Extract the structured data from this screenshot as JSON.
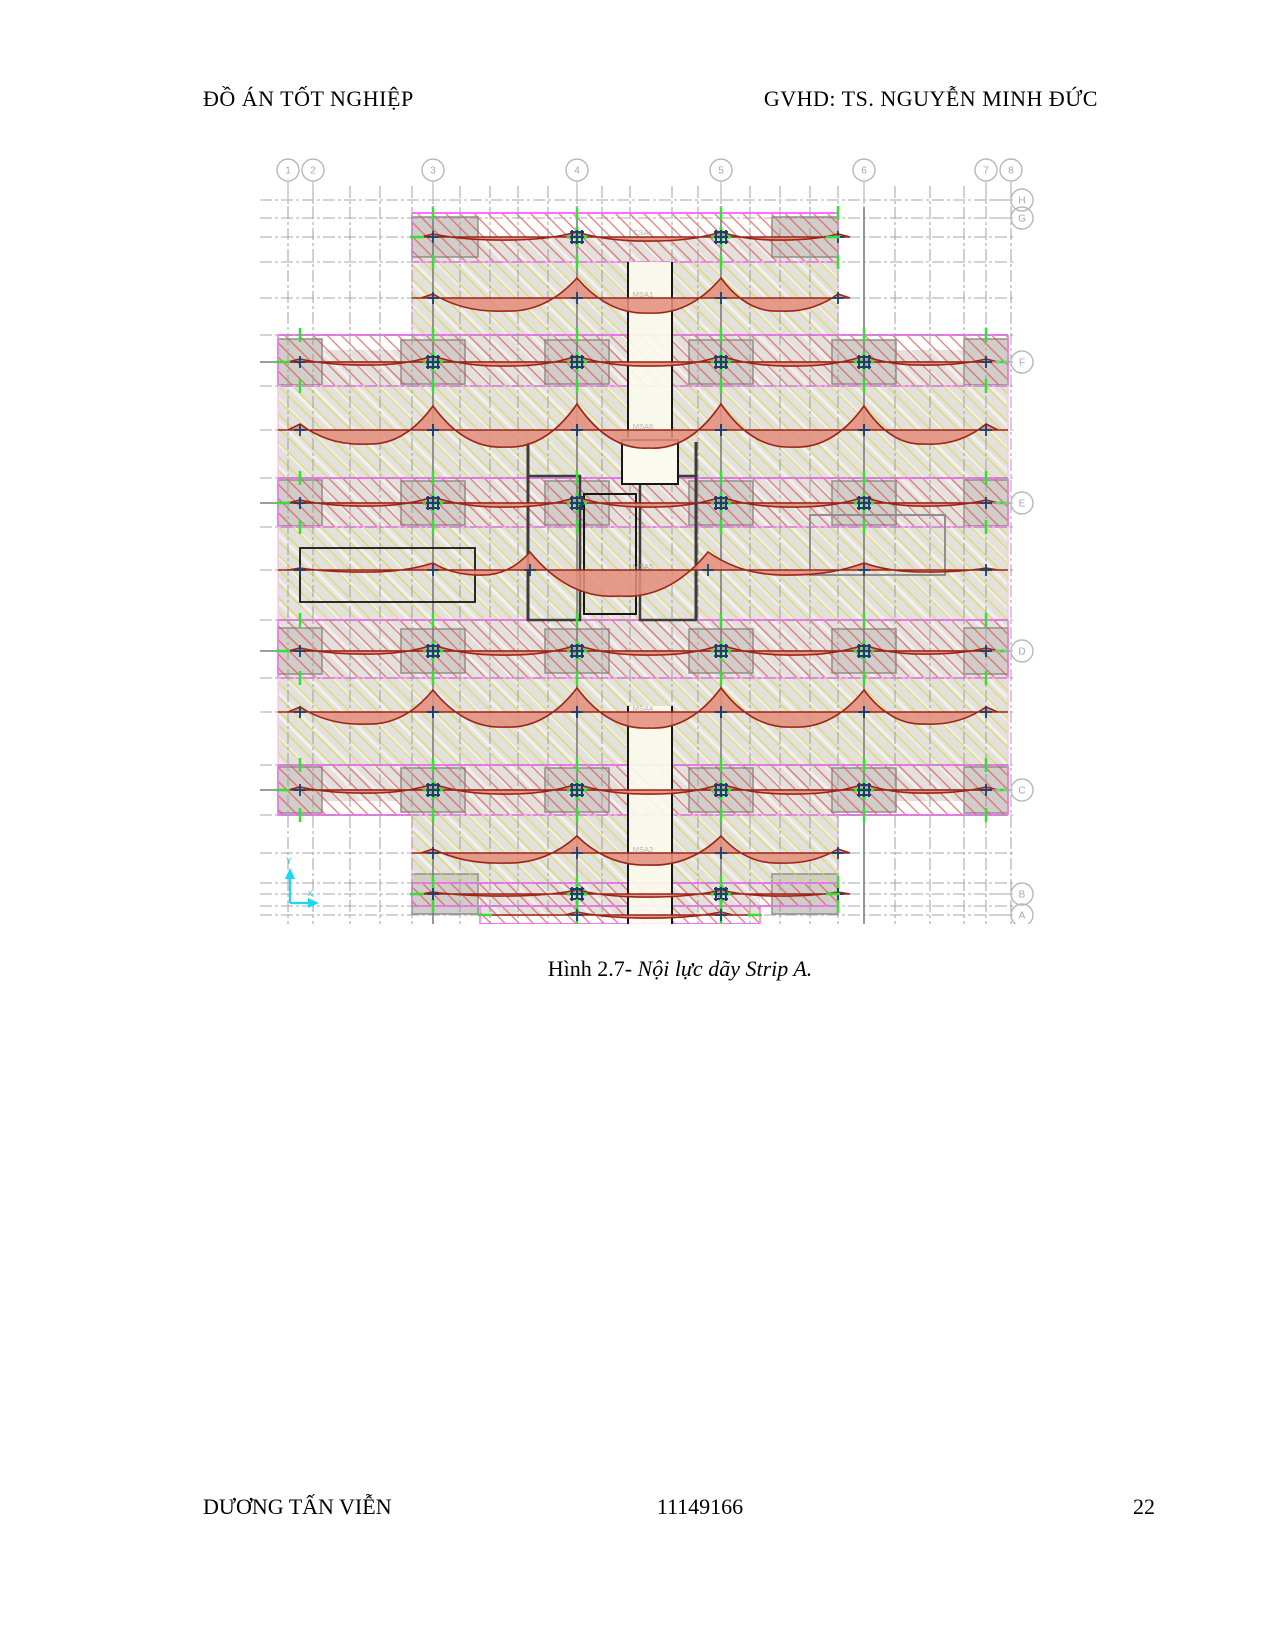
{
  "header": {
    "left": "ĐỒ ÁN TỐT NGHIỆP",
    "right": "GVHD: TS. NGUYỄN MINH ĐỨC"
  },
  "caption": {
    "prefix": "Hình 2.7- ",
    "italic": "Nội lực dãy Strip A."
  },
  "footer": {
    "author": "DƯƠNG TẤN VIỄN",
    "student_id": "11149166",
    "page_number": "22"
  },
  "diagram": {
    "top_bubbles": [
      {
        "label": "1",
        "x": 38
      },
      {
        "label": "2",
        "x": 63
      },
      {
        "label": "3",
        "x": 183
      },
      {
        "label": "4",
        "x": 327
      },
      {
        "label": "5",
        "x": 471
      },
      {
        "label": "6",
        "x": 614
      },
      {
        "label": "7",
        "x": 736
      },
      {
        "label": "8",
        "x": 761
      }
    ],
    "right_bubbles": [
      {
        "label": "H",
        "y": 54
      },
      {
        "label": "G",
        "y": 72
      },
      {
        "label": "F",
        "y": 216
      },
      {
        "label": "E",
        "y": 357
      },
      {
        "label": "D",
        "y": 505
      },
      {
        "label": "C",
        "y": 644
      },
      {
        "label": "B",
        "y": 748
      },
      {
        "label": "A",
        "y": 769
      }
    ],
    "axis_labels": {
      "y": "Y",
      "x": "x"
    },
    "strip_labels": [
      {
        "t": "CSA1",
        "x": 393,
        "y": 89
      },
      {
        "t": "MSA1",
        "x": 393,
        "y": 151
      },
      {
        "t": "MSA6",
        "x": 393,
        "y": 283
      },
      {
        "t": "MSA5",
        "x": 393,
        "y": 423
      },
      {
        "t": "MSA4",
        "x": 393,
        "y": 565
      },
      {
        "t": "MSA2",
        "x": 393,
        "y": 706
      }
    ],
    "colors": {
      "grid": "#9b9b9b",
      "grid_main": "#7d7d7d",
      "bubble": "#b8b8b8",
      "bubble_text": "#a8a8a8",
      "slab": "#e2e1dd",
      "panel": "#cfceca",
      "panel_edge": "#8f8f8f",
      "red_hatch": "#e4504a",
      "yellow_hatch": "#e0d63d",
      "white_hatch": "#ffffff",
      "magenta": "#ff6eff",
      "pink": "#ffc2ee",
      "moment_fill": "#e2907e",
      "moment_edge": "#9b2417",
      "navy": "#1b3f6e",
      "green": "#33e033",
      "cyan": "#19d8ef",
      "core": "#3c3c3c",
      "black": "#161616",
      "shaft_fill": "#fbfaee"
    },
    "v_grids": [
      38,
      63,
      100,
      130,
      162,
      183,
      210,
      240,
      268,
      298,
      327,
      352,
      380,
      422,
      448,
      471,
      500,
      530,
      560,
      588,
      614,
      645,
      680,
      714,
      736,
      761
    ],
    "h_grids": [
      54,
      72,
      91,
      116,
      152,
      189,
      216,
      240,
      284,
      332,
      357,
      381,
      424,
      474,
      505,
      532,
      566,
      619,
      644,
      669,
      707,
      737,
      748,
      760,
      769
    ],
    "main_v": [
      183,
      327,
      471,
      614
    ],
    "main_h": [
      216,
      357,
      505,
      644
    ],
    "slabs": [
      {
        "x": 162,
        "y": 91,
        "w": 426,
        "h": 113
      },
      {
        "x": 28,
        "y": 204,
        "w": 730,
        "h": 451
      },
      {
        "x": 162,
        "y": 655,
        "w": 426,
        "h": 93
      },
      {
        "x": 230,
        "y": 748,
        "w": 280,
        "h": 22
      }
    ],
    "panels": [
      {
        "x": 151,
        "y": 194,
        "w": 64,
        "h": 44
      },
      {
        "x": 295,
        "y": 194,
        "w": 64,
        "h": 44
      },
      {
        "x": 439,
        "y": 194,
        "w": 64,
        "h": 44
      },
      {
        "x": 582,
        "y": 194,
        "w": 64,
        "h": 44
      },
      {
        "x": 151,
        "y": 335,
        "w": 64,
        "h": 44
      },
      {
        "x": 295,
        "y": 335,
        "w": 64,
        "h": 44
      },
      {
        "x": 439,
        "y": 335,
        "w": 64,
        "h": 44
      },
      {
        "x": 582,
        "y": 335,
        "w": 64,
        "h": 44
      },
      {
        "x": 151,
        "y": 483,
        "w": 64,
        "h": 44
      },
      {
        "x": 295,
        "y": 483,
        "w": 64,
        "h": 44
      },
      {
        "x": 439,
        "y": 483,
        "w": 64,
        "h": 44
      },
      {
        "x": 582,
        "y": 483,
        "w": 64,
        "h": 44
      },
      {
        "x": 151,
        "y": 622,
        "w": 64,
        "h": 44
      },
      {
        "x": 295,
        "y": 622,
        "w": 64,
        "h": 44
      },
      {
        "x": 439,
        "y": 622,
        "w": 64,
        "h": 44
      },
      {
        "x": 582,
        "y": 622,
        "w": 64,
        "h": 44
      },
      {
        "x": 28,
        "y": 193,
        "w": 44,
        "h": 46
      },
      {
        "x": 714,
        "y": 193,
        "w": 44,
        "h": 46
      },
      {
        "x": 28,
        "y": 334,
        "w": 44,
        "h": 46
      },
      {
        "x": 714,
        "y": 334,
        "w": 44,
        "h": 46
      },
      {
        "x": 28,
        "y": 482,
        "w": 44,
        "h": 46
      },
      {
        "x": 714,
        "y": 482,
        "w": 44,
        "h": 46
      },
      {
        "x": 28,
        "y": 621,
        "w": 44,
        "h": 46
      },
      {
        "x": 714,
        "y": 621,
        "w": 44,
        "h": 46
      },
      {
        "x": 162,
        "y": 71,
        "w": 66,
        "h": 40
      },
      {
        "x": 522,
        "y": 71,
        "w": 66,
        "h": 40
      },
      {
        "x": 162,
        "y": 728,
        "w": 66,
        "h": 40
      },
      {
        "x": 522,
        "y": 728,
        "w": 66,
        "h": 40
      }
    ],
    "bands": [
      {
        "kind": "col",
        "x1": 162,
        "x2": 588,
        "y1": 67,
        "y2": 116,
        "base": 91,
        "s": [
          183,
          327,
          471,
          588
        ],
        "p": [
          3,
          5,
          5,
          3
        ],
        "g": [
          3,
          4,
          3
        ]
      },
      {
        "kind": "mid",
        "x1": 162,
        "x2": 588,
        "y1": 116,
        "y2": 189,
        "base": 152,
        "s": [
          183,
          327,
          471,
          588
        ],
        "p": [
          4,
          20,
          20,
          4
        ],
        "g": [
          13,
          15,
          13
        ]
      },
      {
        "kind": "col",
        "x1": 28,
        "x2": 758,
        "y1": 189,
        "y2": 240,
        "base": 216,
        "s": [
          50,
          183,
          327,
          471,
          614,
          736
        ],
        "p": [
          3,
          6,
          6,
          6,
          6,
          3
        ],
        "g": [
          3,
          4,
          4,
          4,
          3
        ]
      },
      {
        "kind": "mid",
        "x1": 28,
        "x2": 758,
        "y1": 240,
        "y2": 332,
        "base": 284,
        "s": [
          50,
          183,
          327,
          471,
          614,
          736
        ],
        "p": [
          6,
          24,
          26,
          26,
          24,
          6
        ],
        "g": [
          14,
          17,
          18,
          17,
          14
        ]
      },
      {
        "kind": "col",
        "x1": 28,
        "x2": 758,
        "y1": 332,
        "y2": 381,
        "base": 357,
        "s": [
          50,
          183,
          327,
          471,
          614,
          736
        ],
        "p": [
          3,
          6,
          6,
          6,
          6,
          3
        ],
        "g": [
          3,
          4,
          4,
          4,
          3
        ]
      },
      {
        "kind": "mid",
        "x1": 28,
        "x2": 758,
        "y1": 381,
        "y2": 474,
        "base": 424,
        "s": [
          50,
          183,
          280,
          458,
          614,
          736
        ],
        "p": [
          2,
          7,
          18,
          18,
          7,
          2
        ],
        "g": [
          2,
          5,
          26,
          5,
          2
        ]
      },
      {
        "kind": "col",
        "x1": 28,
        "x2": 758,
        "y1": 474,
        "y2": 532,
        "base": 505,
        "s": [
          50,
          183,
          327,
          471,
          614,
          736
        ],
        "p": [
          3,
          6,
          6,
          6,
          6,
          3
        ],
        "g": [
          3,
          4,
          4,
          4,
          3
        ]
      },
      {
        "kind": "mid",
        "x1": 28,
        "x2": 758,
        "y1": 532,
        "y2": 619,
        "base": 566,
        "s": [
          50,
          183,
          327,
          471,
          614,
          736
        ],
        "p": [
          5,
          22,
          24,
          24,
          22,
          5
        ],
        "g": [
          12,
          15,
          16,
          15,
          12
        ]
      },
      {
        "kind": "col",
        "x1": 28,
        "x2": 758,
        "y1": 619,
        "y2": 669,
        "base": 644,
        "s": [
          50,
          183,
          327,
          471,
          614,
          736
        ],
        "p": [
          3,
          6,
          6,
          6,
          6,
          3
        ],
        "g": [
          3,
          4,
          4,
          4,
          3
        ]
      },
      {
        "kind": "mid",
        "x1": 162,
        "x2": 588,
        "y1": 669,
        "y2": 737,
        "base": 707,
        "s": [
          183,
          327,
          471,
          588
        ],
        "p": [
          4,
          17,
          17,
          4
        ],
        "g": [
          10,
          12,
          10
        ]
      },
      {
        "kind": "col",
        "x1": 162,
        "x2": 588,
        "y1": 737,
        "y2": 760,
        "base": 748,
        "s": [
          183,
          327,
          471,
          588
        ],
        "p": [
          2,
          4,
          4,
          2
        ],
        "g": [
          2,
          3,
          2
        ]
      },
      {
        "kind": "col",
        "x1": 230,
        "x2": 510,
        "y1": 760,
        "y2": 778,
        "base": 769,
        "s": [
          327,
          471
        ],
        "p": [
          3,
          3
        ],
        "g": [
          3
        ]
      }
    ],
    "shafts": [
      {
        "x": 378,
        "y": 116,
        "w": 44,
        "h": 176
      },
      {
        "x": 378,
        "y": 560,
        "w": 44,
        "h": 218
      }
    ],
    "core_rects": [
      {
        "x": 278,
        "y": 330,
        "w": 52,
        "h": 144,
        "c": "core",
        "lw": 2.5
      },
      {
        "x": 334,
        "y": 348,
        "w": 52,
        "h": 120,
        "c": "black",
        "lw": 2
      },
      {
        "x": 390,
        "y": 330,
        "w": 56,
        "h": 144,
        "c": "core",
        "lw": 2.5
      },
      {
        "x": 372,
        "y": 294,
        "w": 56,
        "h": 44,
        "c": "black",
        "lw": 2,
        "fill": "shaft_fill"
      },
      {
        "x": 50,
        "y": 402,
        "w": 175,
        "h": 54,
        "c": "black",
        "lw": 1.8
      },
      {
        "x": 560,
        "y": 369,
        "w": 135,
        "h": 60,
        "c": "panel_edge",
        "lw": 2
      }
    ]
  }
}
